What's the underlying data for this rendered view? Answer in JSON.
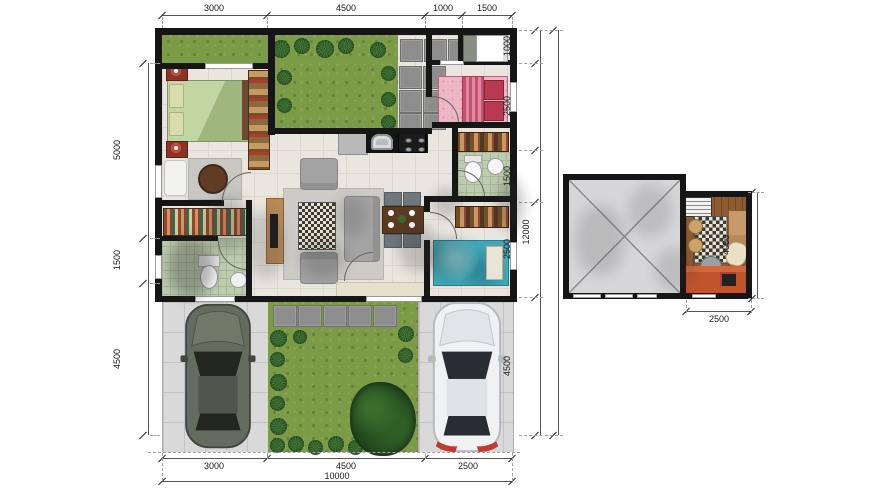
{
  "floor_plan": {
    "main": {
      "dims_top": [
        "3000",
        "4500",
        "1000",
        "1500"
      ],
      "dims_left": [
        "5000",
        "1500",
        "4500"
      ],
      "dims_right": [
        "1000",
        "2500",
        "1500",
        "2500",
        "4500"
      ],
      "dim_right_total": "12000",
      "dims_bottom": [
        "3000",
        "4500",
        "2500"
      ],
      "dim_bottom_total": "10000"
    },
    "upper": {
      "dim_right": "4000",
      "dim_bottom": "2500"
    },
    "colors": {
      "wall": "#161616",
      "grass": "#7c9b47",
      "paver": "#8d8d8d",
      "floor_tile": "#e9e6e0",
      "bath_tile": "#bccdb0",
      "wood_floor": "#8f5a2e",
      "sofa_orange": "#c0542b",
      "car_dark": "#646c5f",
      "car_light": "#eff1f2"
    }
  }
}
